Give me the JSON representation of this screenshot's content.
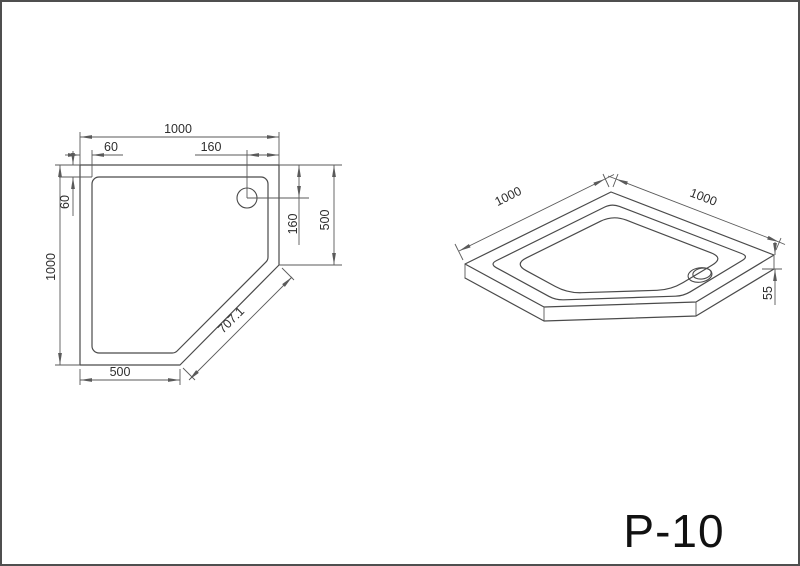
{
  "label": {
    "product_code": "P-10"
  },
  "plan": {
    "dims": {
      "top_width": "1000",
      "top_rim": "60",
      "top_drain": "160",
      "left_height": "1000",
      "left_rim": "60",
      "right_drain": "160",
      "right_side": "500",
      "bottom_width": "500",
      "diagonal": "707.1"
    }
  },
  "iso": {
    "dims": {
      "left_edge": "1000",
      "right_edge": "1000",
      "height": "55"
    }
  },
  "colors": {
    "line": "#4a4a4a",
    "dim_line": "#5a5a5a",
    "text": "#2e2e2e",
    "background": "#ffffff",
    "frame": "#4f4f4f"
  }
}
